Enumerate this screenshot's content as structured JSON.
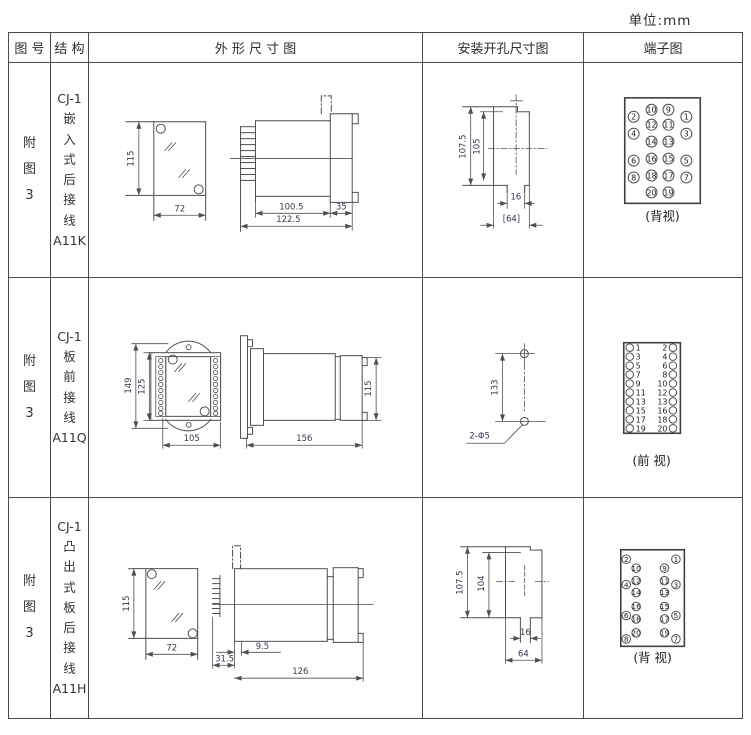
{
  "page": {
    "unit_label": "单位:mm"
  },
  "headers": {
    "fig": "图 号",
    "structure": "结 构",
    "outline": "外 形 尺 寸 图",
    "install": "安装开孔尺寸图",
    "terminal": "端子图"
  },
  "rows": [
    {
      "fig_no": "附\n图\n3",
      "structure": "CJ-1\n嵌\n入\n式\n后\n接\n线\nA11K",
      "outline": {
        "d115": "115",
        "d72": "72",
        "d100_5": "100.5",
        "d122_5": "122.5",
        "d35": "35"
      },
      "install": {
        "d107_5": "107.5",
        "d105": "105",
        "d16": "16",
        "d64": "[64]"
      },
      "terminal": {
        "label": "(背视)",
        "pins": [
          "10",
          "9",
          "2",
          "1",
          "12",
          "11",
          "4",
          "3",
          "14",
          "13",
          "16",
          "15",
          "6",
          "5",
          "18",
          "17",
          "8",
          "7",
          "20",
          "19"
        ]
      }
    },
    {
      "fig_no": "附\n图\n3",
      "structure": "CJ-1\n板\n前\n接\n线\nA11Q",
      "outline": {
        "d149": "149",
        "d125": "125",
        "d105": "105",
        "d156": "156",
        "d115": "115"
      },
      "install": {
        "d133": "133",
        "hole": "2-Φ5"
      },
      "terminal": {
        "label": "(前 视)",
        "left": [
          "1",
          "3",
          "5",
          "7",
          "9",
          "11",
          "13",
          "15",
          "17",
          "19"
        ],
        "right": [
          "2",
          "4",
          "6",
          "8",
          "10",
          "12",
          "13",
          "16",
          "18",
          "20"
        ]
      }
    },
    {
      "fig_no": "附\n图\n3",
      "structure": "CJ-1\n凸\n出\n式\n板\n后\n接\n线\nA11H",
      "outline": {
        "d115": "115",
        "d72": "72",
        "d31_5": "31.5",
        "d9_5": "9.5",
        "d126": "126"
      },
      "install": {
        "d107_5": "107.5",
        "d104": "104",
        "d16": "16",
        "d64": "64"
      },
      "terminal": {
        "label": "(背 视)",
        "pins": [
          "2",
          "1",
          "10",
          "9",
          "12",
          "11",
          "4",
          "3",
          "14",
          "13",
          "16",
          "15",
          "6",
          "5",
          "18",
          "17",
          "20",
          "19",
          "8",
          "7"
        ]
      }
    }
  ]
}
